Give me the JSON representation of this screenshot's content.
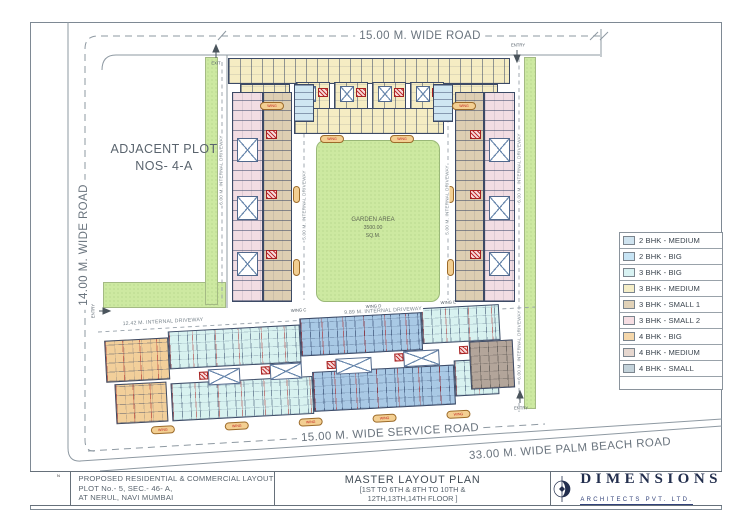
{
  "roads": {
    "top": "15.00 M. WIDE ROAD",
    "left": "14.00 M. WIDE ROAD",
    "service": "15.00 M. WIDE SERVICE ROAD",
    "palm_beach": "33.00 M. WIDE PALM BEACH ROAD"
  },
  "plot": {
    "adjacent_line1": "ADJACENT PLOT",
    "adjacent_line2": "NOS- 4-A",
    "garden_line1": "GARDEN AREA",
    "garden_line2": "3500.00",
    "garden_line3": "SQ.M."
  },
  "driveways": {
    "left_vertical": "6.00 M. INTERNAL DRIVEWAY",
    "mid_left_vertical": "5.00 M. INTERNAL DRIVEWAY",
    "mid_right_vertical": "5.00 M. INTERNAL DRIVEWAY",
    "right_vertical_upper": "6.00 M. INTERNAL DRIVEWAY",
    "right_vertical_lower": "6.00 M. INTERNAL DRIVEWAY",
    "bottom_left": "12.42 M. INTERNAL DRIVEWAY",
    "bottom_right": "9.89 M. INTERNAL DRIVEWAY"
  },
  "markers": {
    "entry": "ENTRY",
    "exit": "EXIT",
    "north": "N"
  },
  "wings": {
    "label_c": "WING C",
    "label_d": "WING D",
    "label_e": "WING E",
    "pill": "WING"
  },
  "legend": {
    "items": [
      {
        "label": "2 BHK - MEDIUM",
        "color": "#cfe3ef"
      },
      {
        "label": "2 BHK - BIG",
        "color": "#c7e4f4"
      },
      {
        "label": "3 BHK - BIG",
        "color": "#d8f2f2"
      },
      {
        "label": "3 BHK - MEDIUM",
        "color": "#f5eec7"
      },
      {
        "label": "3 BHK - SMALL 1",
        "color": "#e1d2b8"
      },
      {
        "label": "3 BHK - SMALL 2",
        "color": "#f6dee3"
      },
      {
        "label": "4 BHK - BIG",
        "color": "#f5d7aa"
      },
      {
        "label": "4 BHK - MEDIUM",
        "color": "#e6d7cf"
      },
      {
        "label": "4 BHK - SMALL",
        "color": "#c3d2da"
      }
    ]
  },
  "title_block": {
    "project_line1": "PROPOSED RESIDENTIAL & COMMERCIAL LAYOUT",
    "project_line2": "PLOT No.- 5, SEC.- 46- A,",
    "project_line3": "AT NERUL, NAVI MUMBAI",
    "plan_title": "MASTER LAYOUT PLAN",
    "plan_sub1": "[1ST TO 6TH & 8TH TO 10TH &",
    "plan_sub2": "12TH,13TH,14TH FLOOR ]",
    "firm_name": "DIMENSIONS",
    "firm_sub": "ARCHITECTS PVT. LTD."
  },
  "colors": {
    "garden_green": "#cde9a1",
    "line_gray": "#8e99a2",
    "accent_red": "#c03030",
    "brand_navy": "#232f4e"
  }
}
